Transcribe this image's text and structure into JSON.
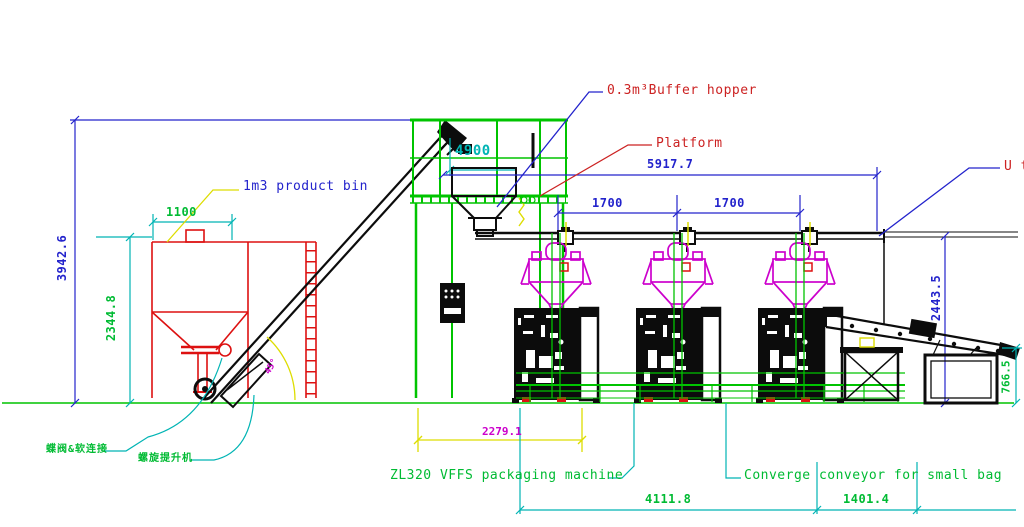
{
  "drawing": {
    "labels": {
      "product_bin": "1m3 product bin",
      "buffer_hopper": "0.3m³Buffer hopper",
      "platform": "Platform",
      "u_type": "U ty",
      "vffs_machine": "ZL320 VFFS packaging machine",
      "converge_conveyor": "Converge conveyor for small bag",
      "valve_connection_cn": "蝶阀&软连接",
      "screw_elevator_cn": "螺旋提升机"
    },
    "dimensions": {
      "bin_width": "1100",
      "bin_height": "2344.8",
      "overall_height": "3942.6",
      "platform_dim": "4900",
      "rail_span": "5917.7",
      "station_pitch_1": "1700",
      "station_pitch_2": "1700",
      "rail_height": "2443.5",
      "infeed_length": "2279.1",
      "line_length": "4111.8",
      "takeoff_length": "1401.4",
      "discharge_height": "766.5",
      "incline_angle": "45°"
    },
    "colors": {
      "structure_green": "#00c400",
      "dimension_cyan": "#00b4b4",
      "dimension_blue": "#2323cc",
      "equipment_red": "#dd1111",
      "weigher_magenta": "#cc00cc",
      "dimension_yellow": "#dddd00",
      "line_black": "#0c0c0c"
    }
  }
}
